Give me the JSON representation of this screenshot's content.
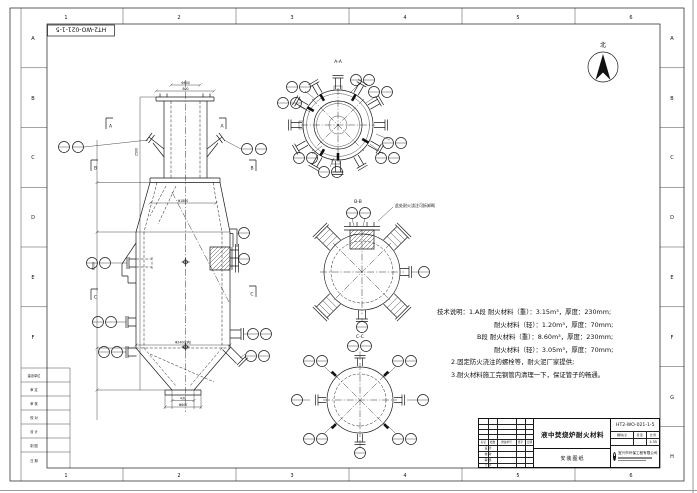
{
  "frame": {
    "cols": [
      "1",
      "2",
      "3",
      "4",
      "5",
      "6"
    ],
    "rows": [
      "A",
      "B",
      "C",
      "D",
      "E",
      "F",
      "G",
      "H"
    ]
  },
  "stamp": {
    "drawing_no_rotated": "HT2-WO-021-1-5"
  },
  "compass": {
    "north_label": "北"
  },
  "sections": {
    "a_title": "A-A",
    "b_title": "B-B",
    "c_title": "C-C",
    "marker_a": "A",
    "marker_b": "B",
    "marker_c": "C"
  },
  "callout_note": "此处耐火浇注可拆卸砌",
  "notes": {
    "heading": "技术说明：",
    "lines": [
      "1.A段 耐火材料（重）：3.15m³，厚度：230mm;",
      "耐火材料（轻）：1.20m³，厚度：70mm;",
      "B段 耐火材料（重）：8.60m³，厚度：230mm;",
      "耐火材料（轻）：3.05m³，厚度：70mm;",
      "2.固定防火浇注的螺栓等，耐火泥厂家提供;",
      "3.耐火材料施工完钢管内清理一下，保证管子的畅通。"
    ]
  },
  "dims": {
    "top1": "Φ600",
    "top2": "800",
    "mid1": "Φ1800",
    "mid2": "Φ2400(内)",
    "bot1": "430",
    "bot2": "Φ600",
    "left1": "6000",
    "left2": "2500"
  },
  "left_strip": {
    "rows": [
      "建设单位",
      "审 定",
      "审 核",
      "校 对",
      "设 计",
      "制 图",
      "日 期"
    ]
  },
  "title_block": {
    "drawing_no": "HT2-WO-021-1-5",
    "title": "液中焚烧炉耐火材料",
    "sheet_type": "安装图纸",
    "mark_label": "图样标记",
    "weight_label": "质 量",
    "scale_label": "比 例",
    "scale": "1:35",
    "company": "宜兴市环保工程有限公司",
    "rev_header": [
      "标记",
      "处数",
      "修改单号",
      "签字",
      "日期"
    ],
    "sig_rows": [
      "设 计",
      "校 对",
      "审 核",
      "工 艺"
    ]
  }
}
